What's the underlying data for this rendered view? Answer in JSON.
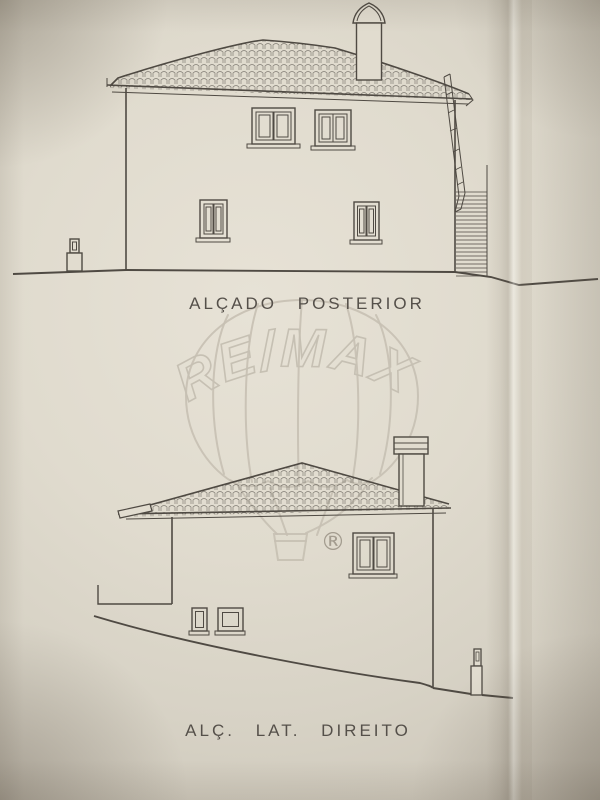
{
  "document": {
    "kind": "architectural elevation drawings, photographed sheet"
  },
  "drawings": [
    {
      "name": "rear-elevation",
      "title": "ALÇADO POSTERIOR",
      "elements": {
        "roof": "hipped tiled roof",
        "roof_chimneys": 1,
        "upper_windows": 2,
        "lower_windows": 2,
        "ground_chimney_left": 1,
        "external_stair_right": true
      }
    },
    {
      "name": "right-side-elevation",
      "title": "ALÇ. LAT. DIREITO",
      "elements": {
        "roof": "hipped tiled roof",
        "roof_chimneys": 1,
        "windows": 1,
        "basement_openings": 2,
        "ground_chimney_right": 1,
        "sloped_ground": true
      }
    }
  ],
  "watermark": {
    "brand": "RE/MAX",
    "registered_mark": "®",
    "icon": "hot-air-balloon"
  },
  "colors": {
    "paper": "#e1dccf",
    "ink": "#4f4a43",
    "title_text": "#55504a",
    "watermark": "#c6c0b3",
    "registered_mark": "#a39c8f"
  }
}
